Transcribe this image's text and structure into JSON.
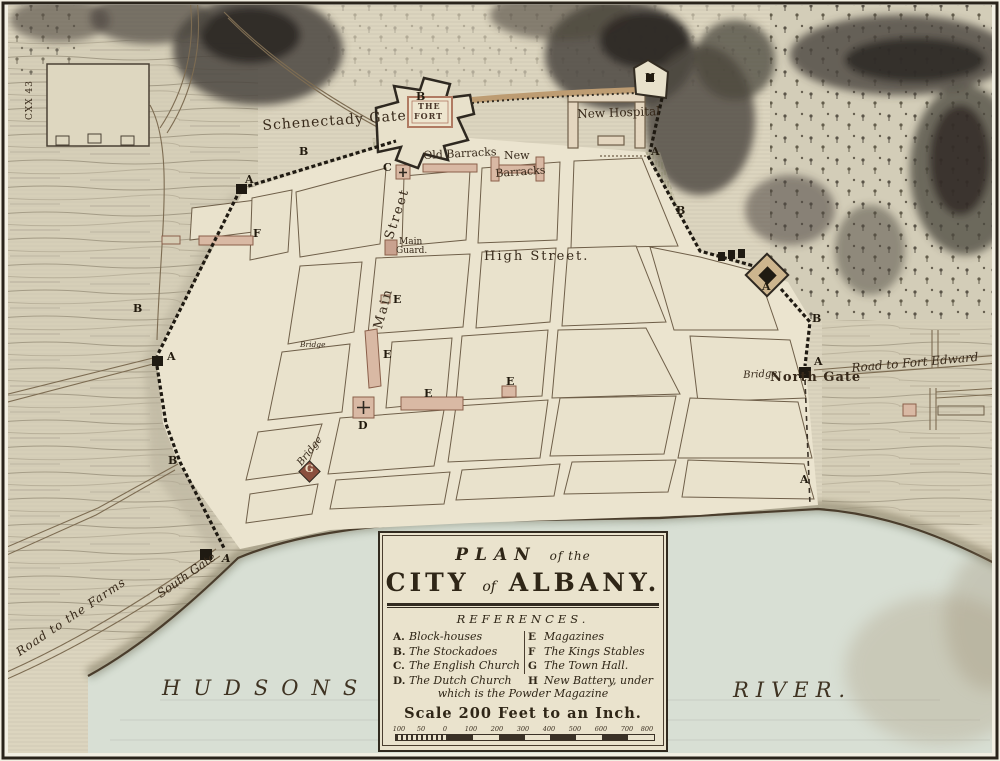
{
  "map": {
    "labels": {
      "schenectady_gate": "Schenectady Gate",
      "fort_line1": "THE",
      "fort_line2": "FORT",
      "new_hospital": "New Hospital",
      "old_barracks": "Old Barracks",
      "new_barracks_line1": "New",
      "new_barracks_line2": "Barracks",
      "street_vertical": "Street",
      "main_vertical": "Main",
      "main_guard_line1": "Main",
      "main_guard_line2": "Guard.",
      "high_street": "High Street.",
      "bridge_small": "Bridge",
      "bridge_diagonal": "Bridge",
      "bridge_north": "Bridge",
      "north_gate": "North Gate",
      "road_to_fort_edward": "Road to Fort Edward",
      "south_gate": "South Gate",
      "road_to_the_farms": "Road to the Farms",
      "hudsons": "HUDSONS",
      "river": "RIVER.",
      "plot_number": "CXX 43"
    },
    "markers": {
      "nw_blockhouse": "A",
      "nw_stockade": "B",
      "west_stockade": "B",
      "west_blockhouse": "A",
      "southwest_stockade": "B",
      "south_gate_blockhouse": "A",
      "english_church": "C",
      "fort_curtain": "B",
      "new_battery": "H",
      "east_stockade_upper": "A",
      "east_stockade_mid": "B",
      "east_redoubt": "A",
      "northeast_stockade": "B",
      "north_gate_blockhouse": "A",
      "riverside_blockhouse": "A",
      "dutch_church": "D",
      "magazine_small": "E",
      "magazine_vertical": "E",
      "magazine_long": "E",
      "magazine_east": "E",
      "town_hall": "G",
      "kings_stables": "F"
    }
  },
  "cartouche": {
    "title_plan": "PLAN",
    "title_of_the": "of the",
    "title_city": "CITY",
    "title_of": "of",
    "title_albany": "ALBANY.",
    "references_title": "REFERENCES.",
    "refs_left": [
      {
        "key": "A.",
        "label": "Block-houses"
      },
      {
        "key": "B.",
        "label": "The Stockadoes"
      },
      {
        "key": "C.",
        "label": "The English Church"
      },
      {
        "key": "D.",
        "label": "The Dutch Church"
      }
    ],
    "refs_right": [
      {
        "key": "E",
        "label": "Magazines"
      },
      {
        "key": "F",
        "label": "The Kings Stables"
      },
      {
        "key": "G",
        "label": "The Town Hall."
      },
      {
        "key": "H",
        "label": "New Battery, under"
      }
    ],
    "footnote": "which is the Powder Magazine",
    "scale_label": "Scale 200 Feet to an Inch.",
    "scale_ticks": [
      "100",
      "50",
      "0",
      "100",
      "200",
      "300",
      "400",
      "500",
      "600",
      "700",
      "800 Feet"
    ]
  }
}
